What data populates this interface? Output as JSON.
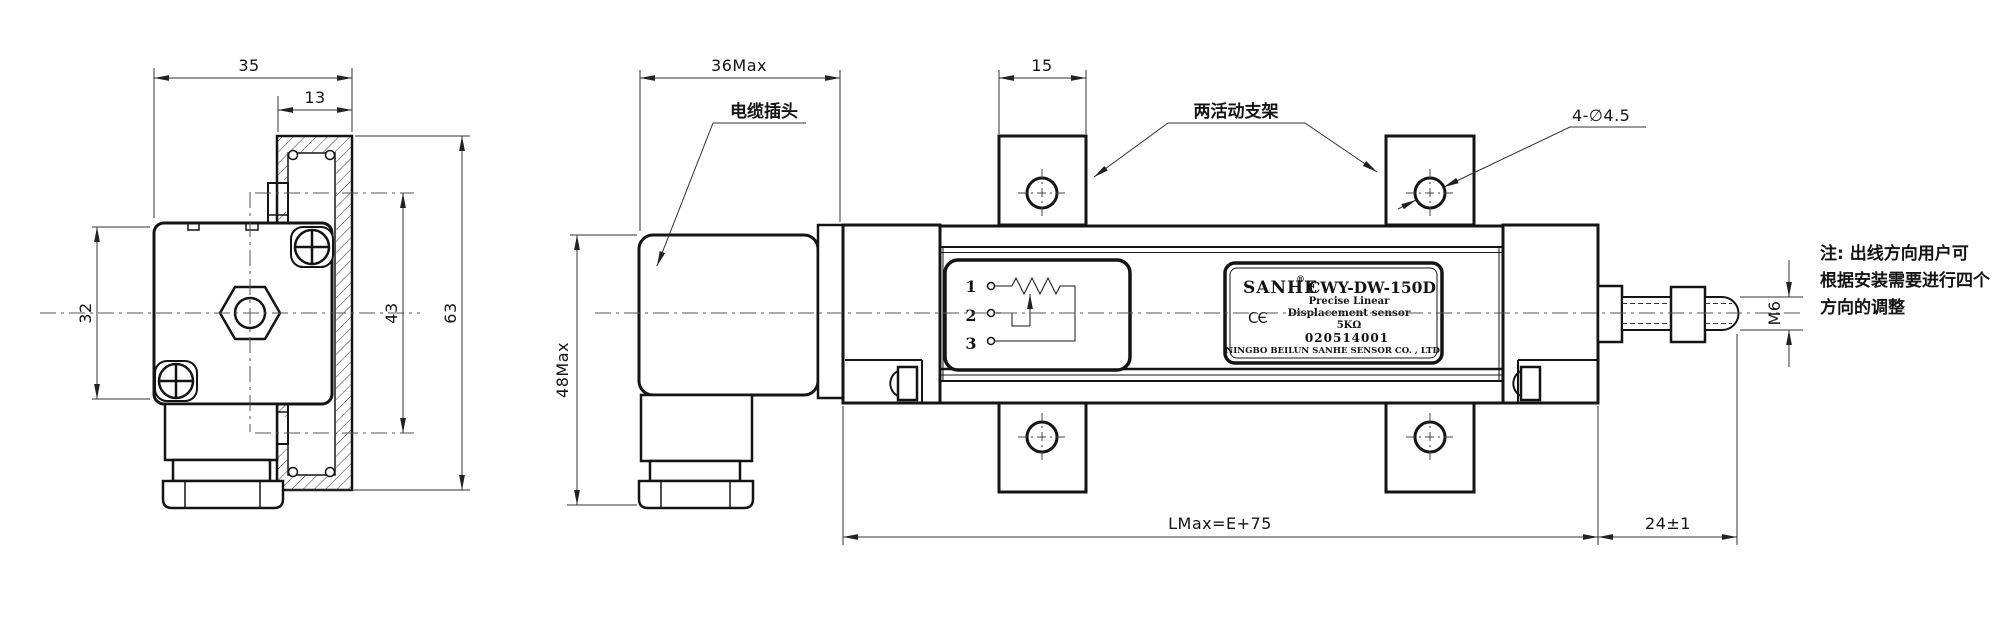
{
  "colors": {
    "line": "#141414",
    "background": "#ffffff",
    "centerline": "#555555"
  },
  "left_view": {
    "dims": {
      "overall_width": "35",
      "bracket_width": "13",
      "body_height": "32",
      "hole_spacing": "43",
      "bracket_height": "63"
    }
  },
  "side_view": {
    "dims": {
      "connector_width": "36Max",
      "connector_height": "48Max",
      "bracket_foot_width": "15",
      "mounting_holes": "4-∅4.5",
      "body_length": "LMax=E+75",
      "rod_extension": "24±1",
      "thread": "M6"
    },
    "labels": {
      "cable_plug": "电缆插头",
      "movable_brackets": "两活动支架"
    },
    "schematic": {
      "terminal1": "1",
      "terminal2": "2",
      "terminal3": "3"
    },
    "nameplate": {
      "brand": "SANHE",
      "reg": "®",
      "model": "CWY-DW-150D",
      "line1": "Precise Linear",
      "line2": "Displacement sensor",
      "ce_mark": "CЄ",
      "resistance": "5KΩ",
      "serial": "020514001",
      "company": "NINGBO BEILUN SANHE SENSOR CO. , LTD."
    }
  },
  "note": {
    "line1": "注: 出线方向用户可",
    "line2": "根据安装需要进行四个",
    "line3": "方向的调整"
  }
}
